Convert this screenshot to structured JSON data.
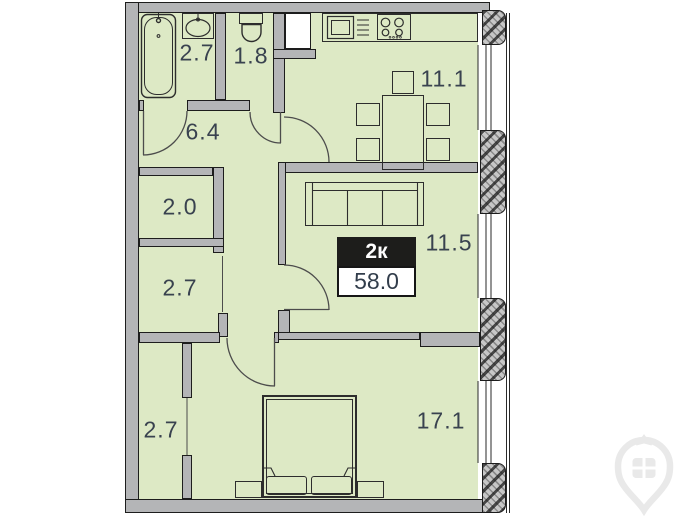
{
  "plan": {
    "badge": {
      "type": "2к",
      "area": "58.0"
    },
    "rooms": {
      "bathroom": {
        "area": "2.7"
      },
      "wc": {
        "area": "1.8"
      },
      "kitchen": {
        "area": "11.1"
      },
      "hallway": {
        "area": "6.4"
      },
      "closet": {
        "area": "2.0"
      },
      "storage": {
        "area": "2.7"
      },
      "living": {
        "area": "11.5"
      },
      "wardrobe": {
        "area": "2.7"
      },
      "bedroom": {
        "area": "17.1"
      }
    },
    "colors": {
      "room_fill": "#dde9c5",
      "wall_fill": "#b4b5b7",
      "wall_outline": "#1d1d1d",
      "label_text": "#39424f",
      "badge_background": "#1d1d1b",
      "badge_type_text": "#ffffff",
      "badge_area_text": "#323d4b",
      "logo_watermark": "#e9e9e9"
    }
  }
}
